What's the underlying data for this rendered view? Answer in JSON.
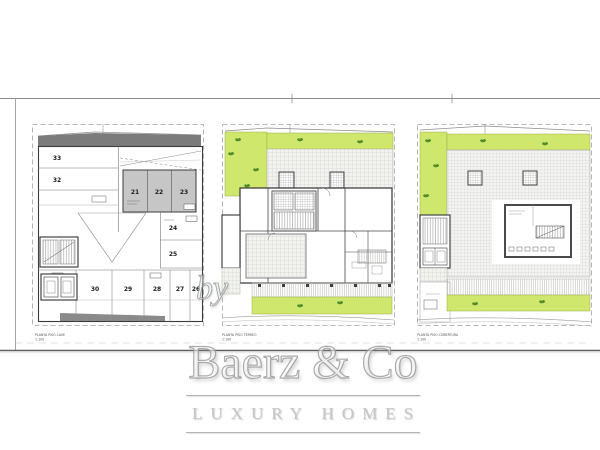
{
  "colors": {
    "garden_green": "#cfe76d",
    "plant_green": "#4e8c2c",
    "parking_gray": "#c6c6c6",
    "roof_strip_gray": "#7b7b7b",
    "wall_line": "#3c3c3c",
    "watermark_gray": "#c6c6c6"
  },
  "plans": [
    {
      "name": "basement-parking-plan",
      "caption": "PLANTA PISO CAVE",
      "scale": "1:100",
      "spaces_left": [
        "33",
        "32"
      ],
      "spaces_covered": [
        "21",
        "22",
        "23"
      ],
      "spaces_right": [
        "24",
        "25"
      ],
      "spaces_bottom": [
        "31",
        "30",
        "29",
        "28",
        "27",
        "26"
      ]
    },
    {
      "name": "ground-floor-plan",
      "caption": "PLANTA PISO TÉRREO",
      "scale": "1:100"
    },
    {
      "name": "roof-plan",
      "caption": "PLANTA PISO COBERTURA",
      "scale": "1:100"
    }
  ],
  "watermark": {
    "by": "by",
    "brand": "Baerz & Co",
    "tagline": "LUXURY HOMES"
  }
}
